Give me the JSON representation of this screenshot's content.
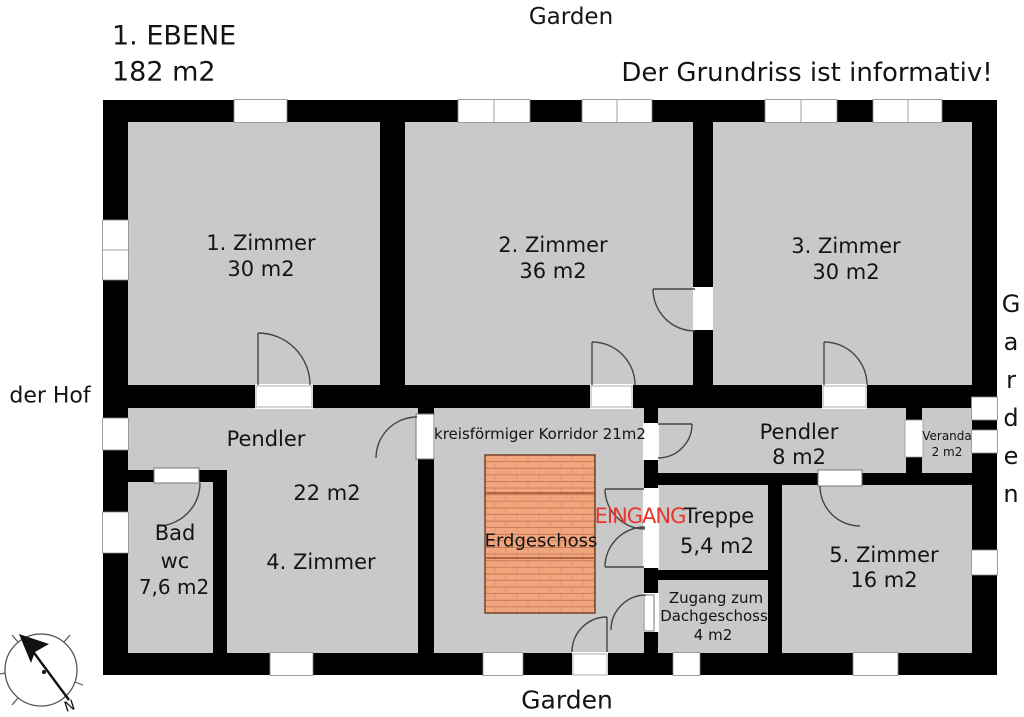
{
  "header": {
    "level_title": "1. EBENE",
    "level_area": "182 m2",
    "disclaimer": "Der Grundriss ist informativ!"
  },
  "surroundings": {
    "garden_top": "Garden",
    "garden_bottom": "Garden",
    "garden_right": "Garden",
    "hof": "der Hof"
  },
  "rooms": {
    "room1": {
      "name": "1. Zimmer",
      "area": "30 m2"
    },
    "room2": {
      "name": "2. Zimmer",
      "area": "36 m2"
    },
    "room3": {
      "name": "3. Zimmer",
      "area": "30 m2"
    },
    "room4": {
      "pendler": "Pendler",
      "area": "22 m2",
      "name": "4. Zimmer"
    },
    "bad": {
      "line1": "Bad",
      "line2": "wc",
      "area": "7,6 m2"
    },
    "korridor": {
      "name": "kreisförmiger Korridor 21m2",
      "stairs_label": "Erdgeschoss"
    },
    "treppe": {
      "name": "Treppe",
      "area": "5,4 m2"
    },
    "zugang": {
      "line1": "Zugang zum",
      "line2": "Dachgeschoss",
      "area": "4 m2"
    },
    "room5": {
      "name": "5. Zimmer",
      "area": "16 m2"
    },
    "pendler2": {
      "name": "Pendler",
      "area": "8 m2"
    },
    "veranda": {
      "name": "Veranda",
      "area": "2 m2"
    }
  },
  "annotations": {
    "eingang": "EINGANG",
    "compass_n": "N"
  },
  "colors": {
    "room_fill": "#c9c9c9",
    "wall": "#000000",
    "stair_fill": "#f0a57d",
    "stair_line": "#c0744e",
    "eingang_red": "#e8362c"
  }
}
